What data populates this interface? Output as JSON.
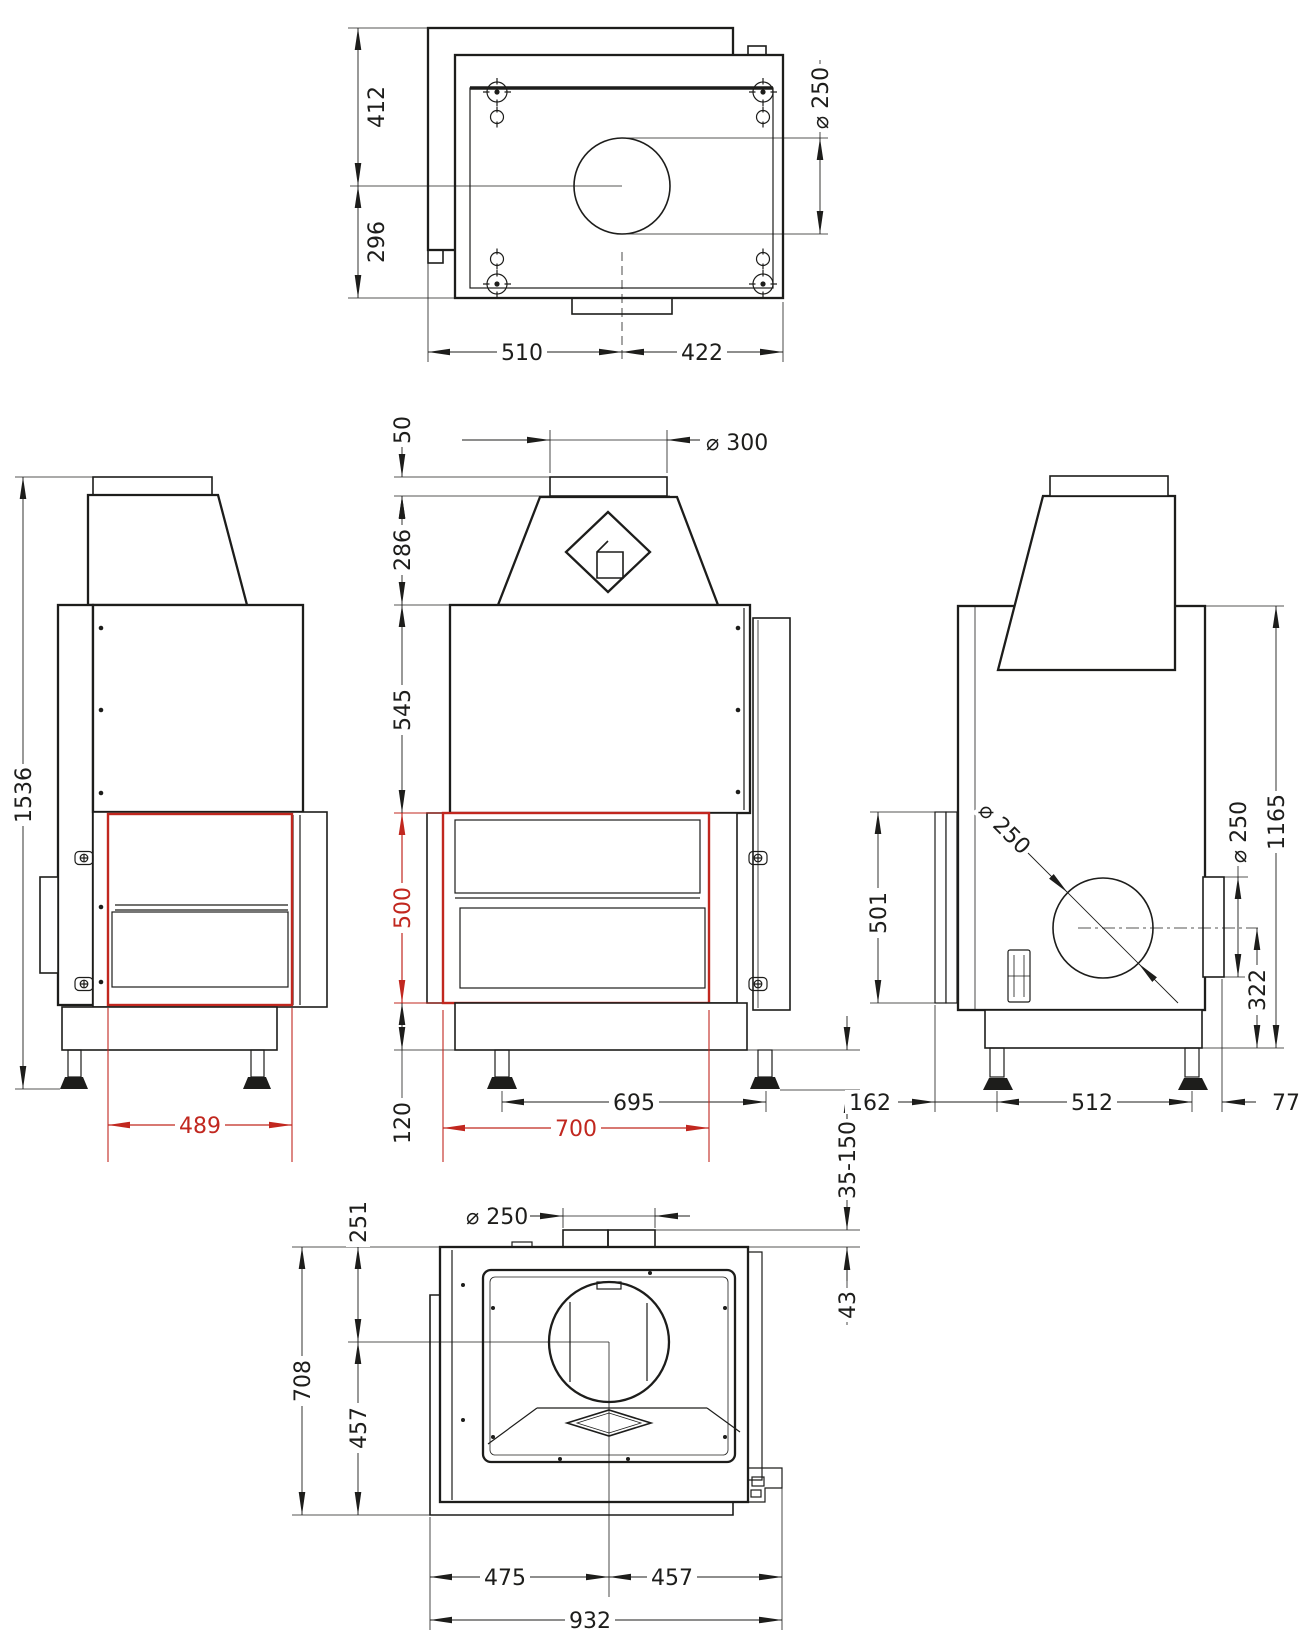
{
  "drawing": {
    "colors": {
      "outline": "#1d1d1b",
      "highlight_red": "#c1271f",
      "background": "#ffffff"
    },
    "dims": {
      "top": {
        "back_depth": "412",
        "front_depth": "296",
        "flue_dia": "⌀ 250",
        "left_width": "510",
        "right_width": "422"
      },
      "left": {
        "total_height": "1536",
        "glass_width": "489"
      },
      "front": {
        "collar_height": "50",
        "hood_height": "286",
        "upper_body_height": "545",
        "glass_height": "500",
        "base_height": "120",
        "flue_dia": "⌀ 300",
        "leg_spacing": "695",
        "glass_width": "700"
      },
      "section": {
        "leg_adjust_range": "35-150",
        "collar_projection": "43"
      },
      "right": {
        "door_height": "501",
        "rear_flue_dia_leader": "⌀ 250",
        "rear_flue_dia": "⌀ 250",
        "flue_center_height": "322",
        "body_height": "1165",
        "front_offset": "162",
        "leg_spacing": "512",
        "rear_offset": "77"
      },
      "bottom": {
        "flue_center_offset": "251",
        "total_depth": "708",
        "front_depth": "457",
        "flue_dia": "⌀ 250",
        "left_width": "475",
        "right_width": "457",
        "total_width": "932"
      }
    }
  }
}
